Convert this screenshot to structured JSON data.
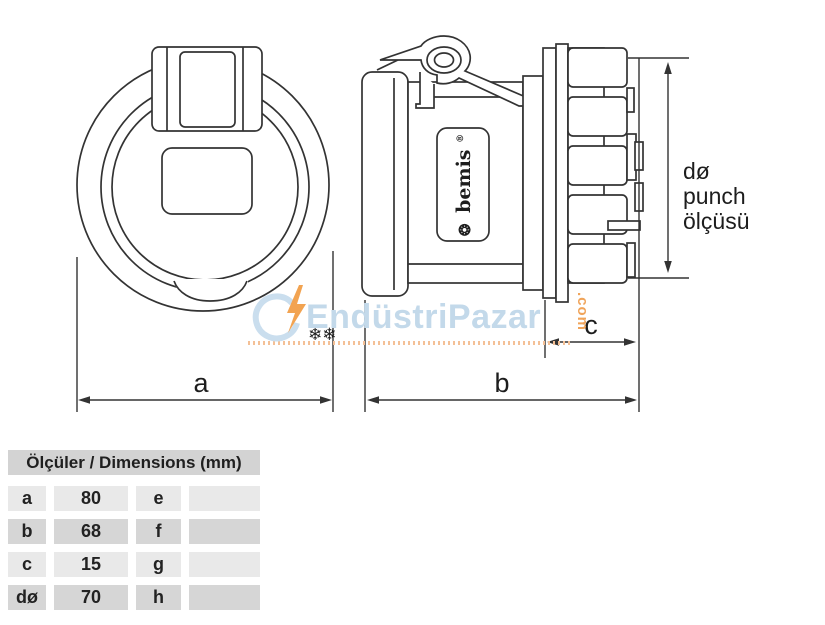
{
  "page": {
    "background": "#ffffff",
    "line_color": "#333333"
  },
  "dimensions": {
    "a_label": "a",
    "b_label": "b",
    "c_label": "c",
    "punch_line1": "dø",
    "punch_line2": "punch",
    "punch_line3": "ölçüsü"
  },
  "brand": {
    "logo_glyph": "❂",
    "name": "bemis",
    "registered": "®"
  },
  "watermark": {
    "text": "EndüstriPazar",
    "suffix": ".com",
    "text_color": "#c3d9ea",
    "accent_color": "#f2a351",
    "icons": [
      "lightning-icon",
      "gear-icon",
      "hook-icon",
      "dotted-line"
    ]
  },
  "table": {
    "header": "Ölçüler / Dimensions (mm)",
    "rows": [
      {
        "key1": "a",
        "val1": "80",
        "key2": "e",
        "val2": ""
      },
      {
        "key1": "b",
        "val1": "68",
        "key2": "f",
        "val2": ""
      },
      {
        "key1": "c",
        "val1": "15",
        "key2": "g",
        "val2": ""
      },
      {
        "key1": "dø",
        "val1": "70",
        "key2": "h",
        "val2": ""
      }
    ]
  }
}
